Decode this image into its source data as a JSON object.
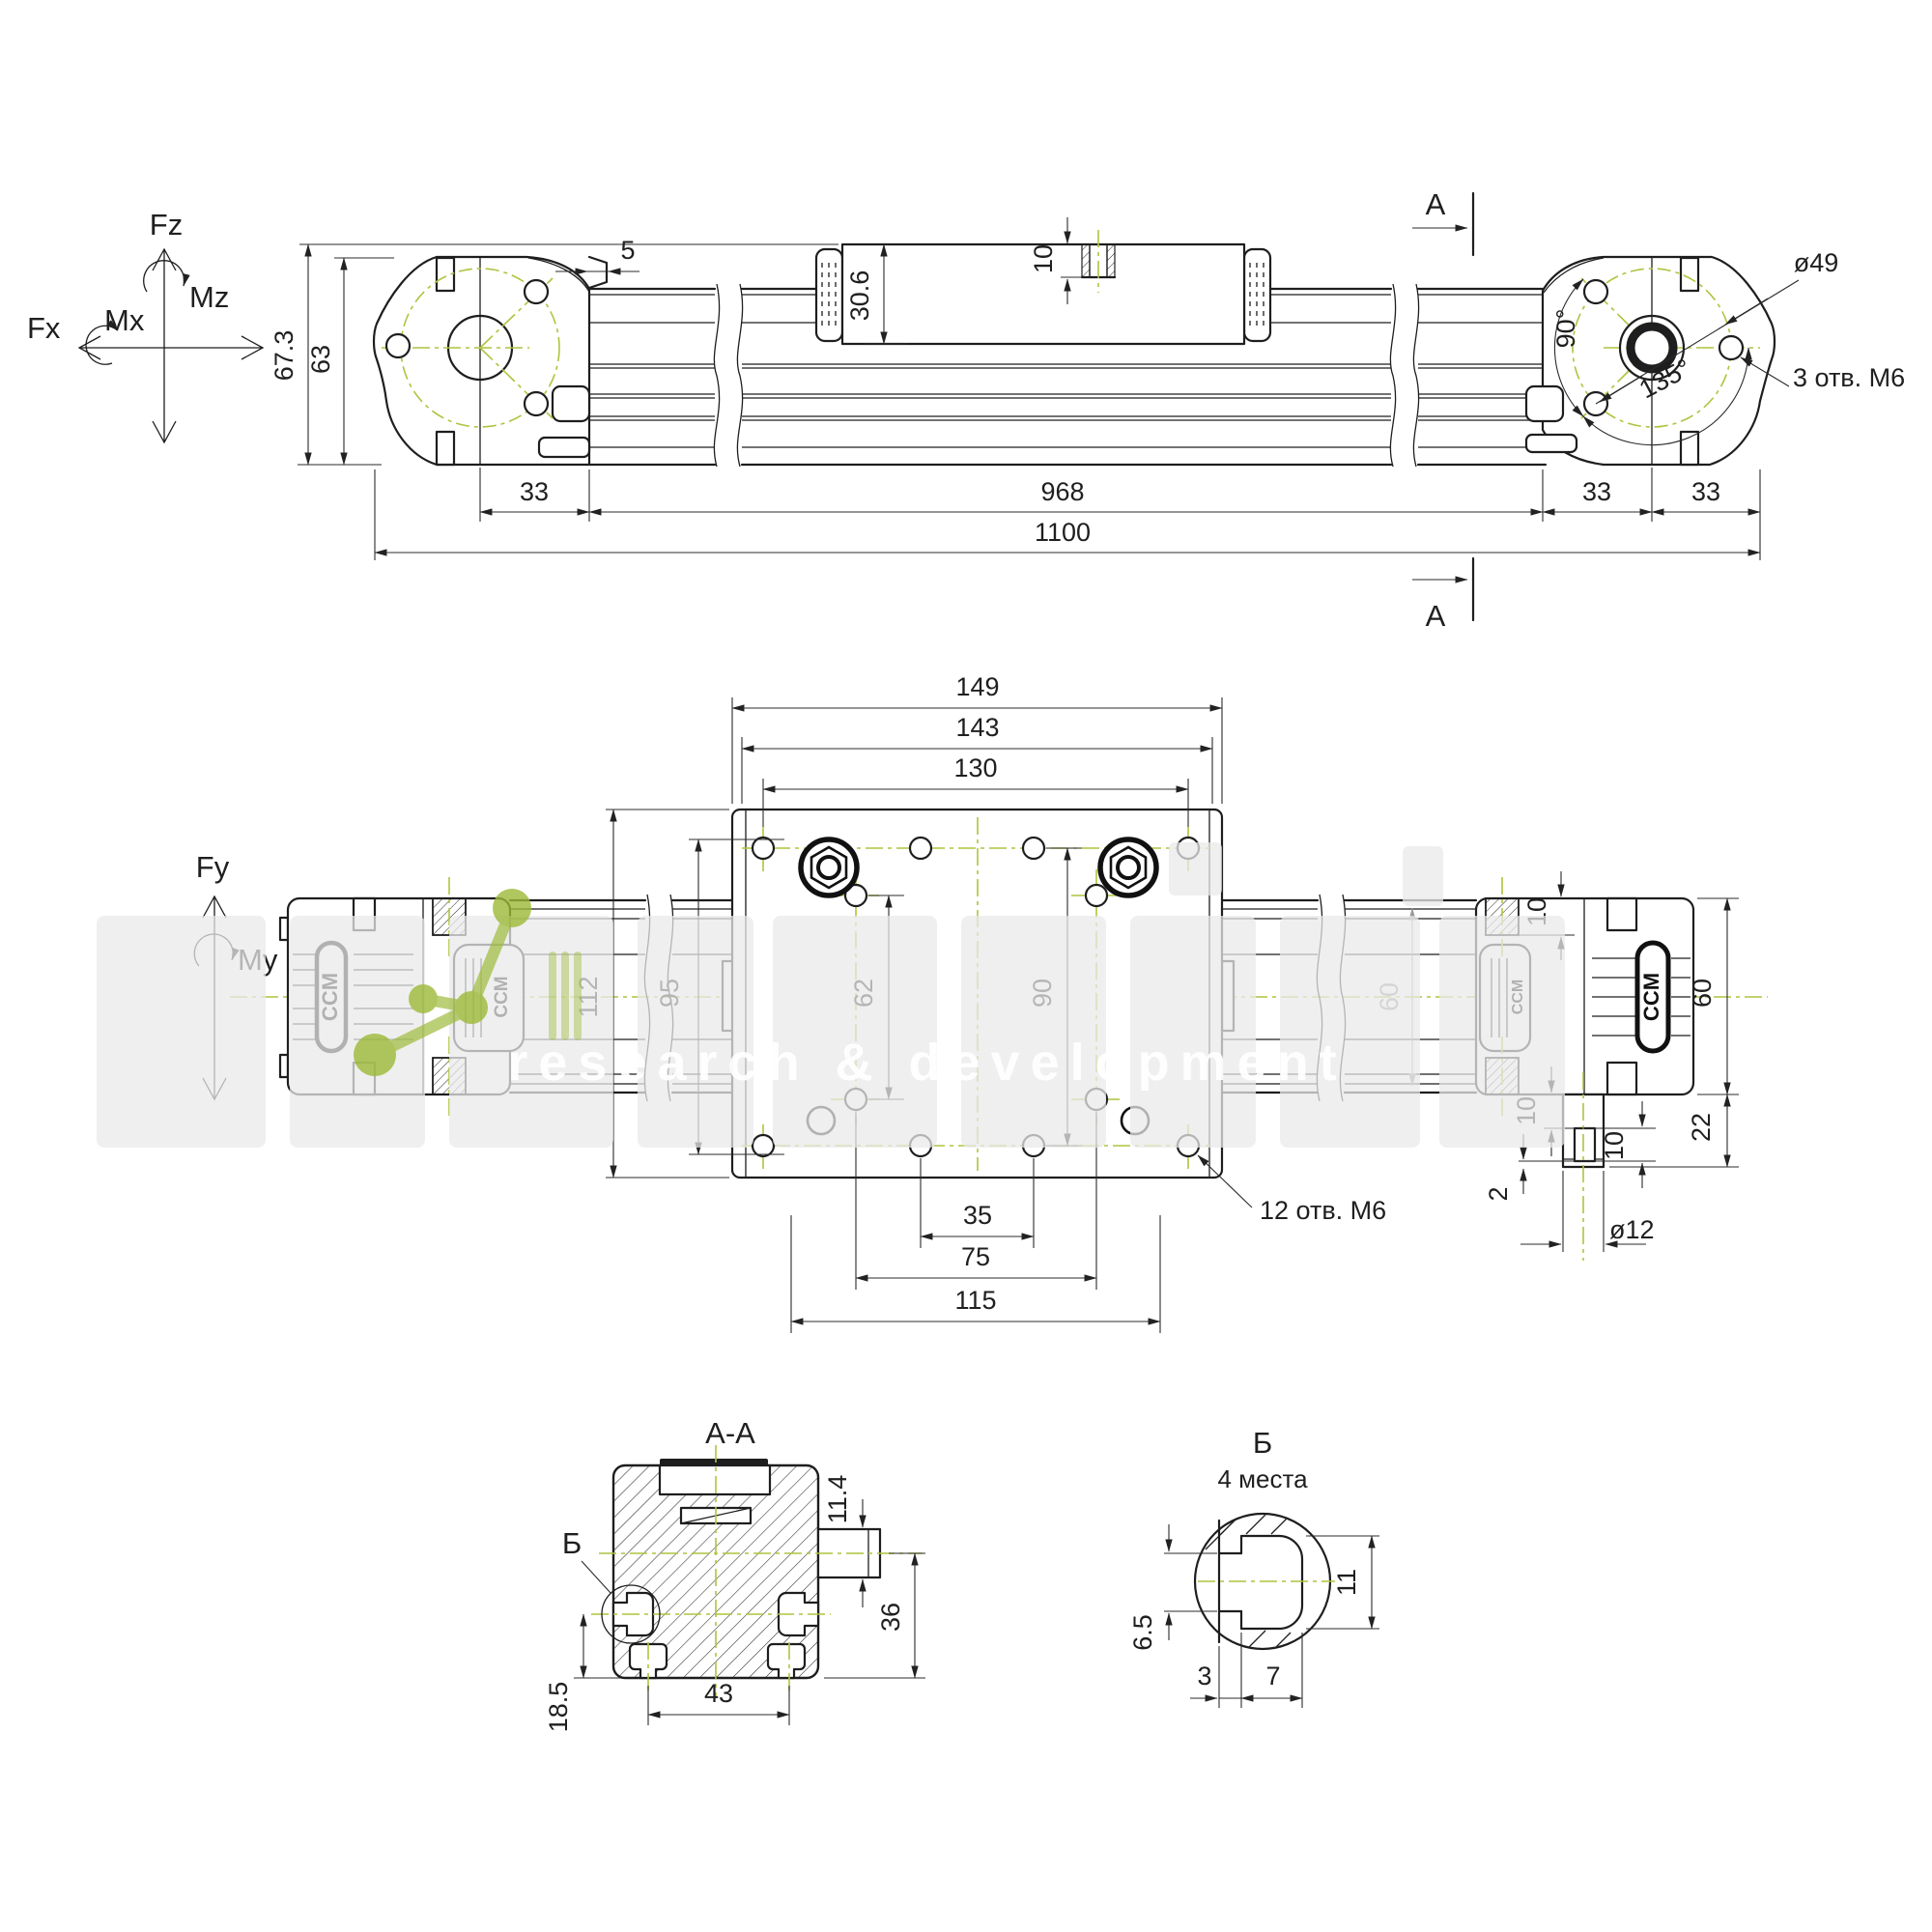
{
  "brand": "CCM",
  "watermark": {
    "tagline": "research & development",
    "accent_color": "#9cba37"
  },
  "colors": {
    "line": "#1e1e1e",
    "centerline": "#aec43e"
  },
  "axes": {
    "fz": "Fz",
    "mz": "Mz",
    "mx": "Mx",
    "fx": "Fx",
    "fy": "Fy",
    "my": "My"
  },
  "top": {
    "h_total": "67.3",
    "h_body": "63",
    "face_gap": "5",
    "carriage_h": "30.6",
    "thread_depth": "10",
    "bolt_circle": "ø49",
    "angle90": "90°",
    "angle135": "135°",
    "end_holes": "3 отв. М6",
    "section": "A",
    "d33_left": "33",
    "stroke_len": "968",
    "d33_r1": "33",
    "d33_r2": "33",
    "total_len": "1100"
  },
  "plan": {
    "w149": "149",
    "w143": "143",
    "w130": "130",
    "h112": "112",
    "h95": "95",
    "h62": "62",
    "h90": "90",
    "rail60": "60",
    "block60": "60",
    "d22": "22",
    "port10": "10",
    "key10_offset": "10",
    "key10_len": "10",
    "d2": "2",
    "shaft": "ø12",
    "d35": "35",
    "d75": "75",
    "d115": "115",
    "plate_holes": "12 отв. М6"
  },
  "section_aa": {
    "title": "A-A",
    "ref": "Б",
    "stub": "11.4",
    "d36": "36",
    "d43": "43",
    "d185": "18.5"
  },
  "detail_b": {
    "title": "Б",
    "subtitle": "4 места",
    "d65": "6.5",
    "d11": "11",
    "d3": "3",
    "d7": "7"
  }
}
